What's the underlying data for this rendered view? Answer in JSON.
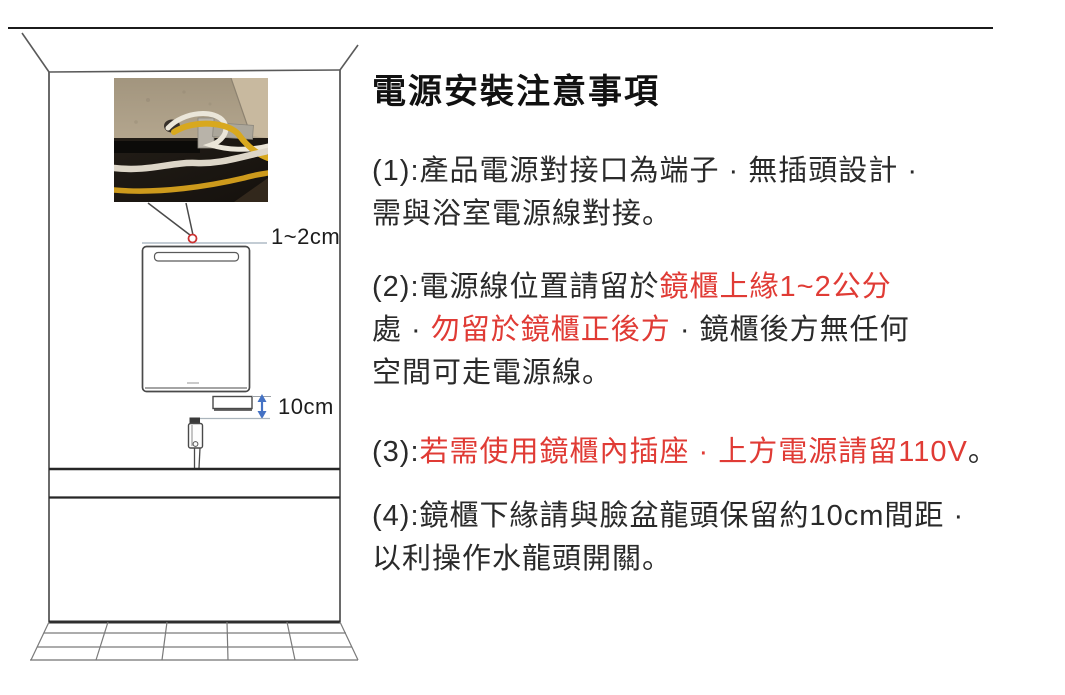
{
  "content": {
    "title": "電源安裝注意事項",
    "colors": {
      "dark": "#2a2a2a",
      "red": "#e03b35"
    },
    "paragraphs": [
      {
        "lines": [
          [
            {
              "t": "(1):產品電源對接口為端子 · 無插頭設計 ·",
              "c": "dark"
            }
          ],
          [
            {
              "t": "需與浴室電源線對接。",
              "c": "dark"
            }
          ]
        ]
      },
      {
        "lines": [
          [
            {
              "t": "(2):電源線位置請留於",
              "c": "dark"
            },
            {
              "t": "鏡櫃上緣1~2公分",
              "c": "red"
            }
          ],
          [
            {
              "t": "處 · ",
              "c": "dark"
            },
            {
              "t": "勿留於鏡櫃正後方",
              "c": "red"
            },
            {
              "t": " · 鏡櫃後方無任何",
              "c": "dark"
            }
          ],
          [
            {
              "t": "空間可走電源線。",
              "c": "dark"
            }
          ]
        ]
      },
      {
        "lines": [
          [
            {
              "t": "(3):",
              "c": "dark"
            },
            {
              "t": "若需使用鏡櫃內插座 · 上方電源請留110V",
              "c": "red"
            },
            {
              "t": "。",
              "c": "dark"
            }
          ]
        ]
      },
      {
        "lines": [
          [
            {
              "t": "(4):鏡櫃下緣請與臉盆龍頭保留約10cm間距 ·",
              "c": "dark"
            }
          ],
          [
            {
              "t": "以利操作水龍頭開關。",
              "c": "dark"
            }
          ]
        ]
      }
    ]
  },
  "diagram": {
    "gap_label": "1~2cm",
    "distance_label": "10cm",
    "colors": {
      "arrow_blue": "#4472c4",
      "marker_red": "#cc3333",
      "line_dark": "#4a4a4a"
    }
  }
}
